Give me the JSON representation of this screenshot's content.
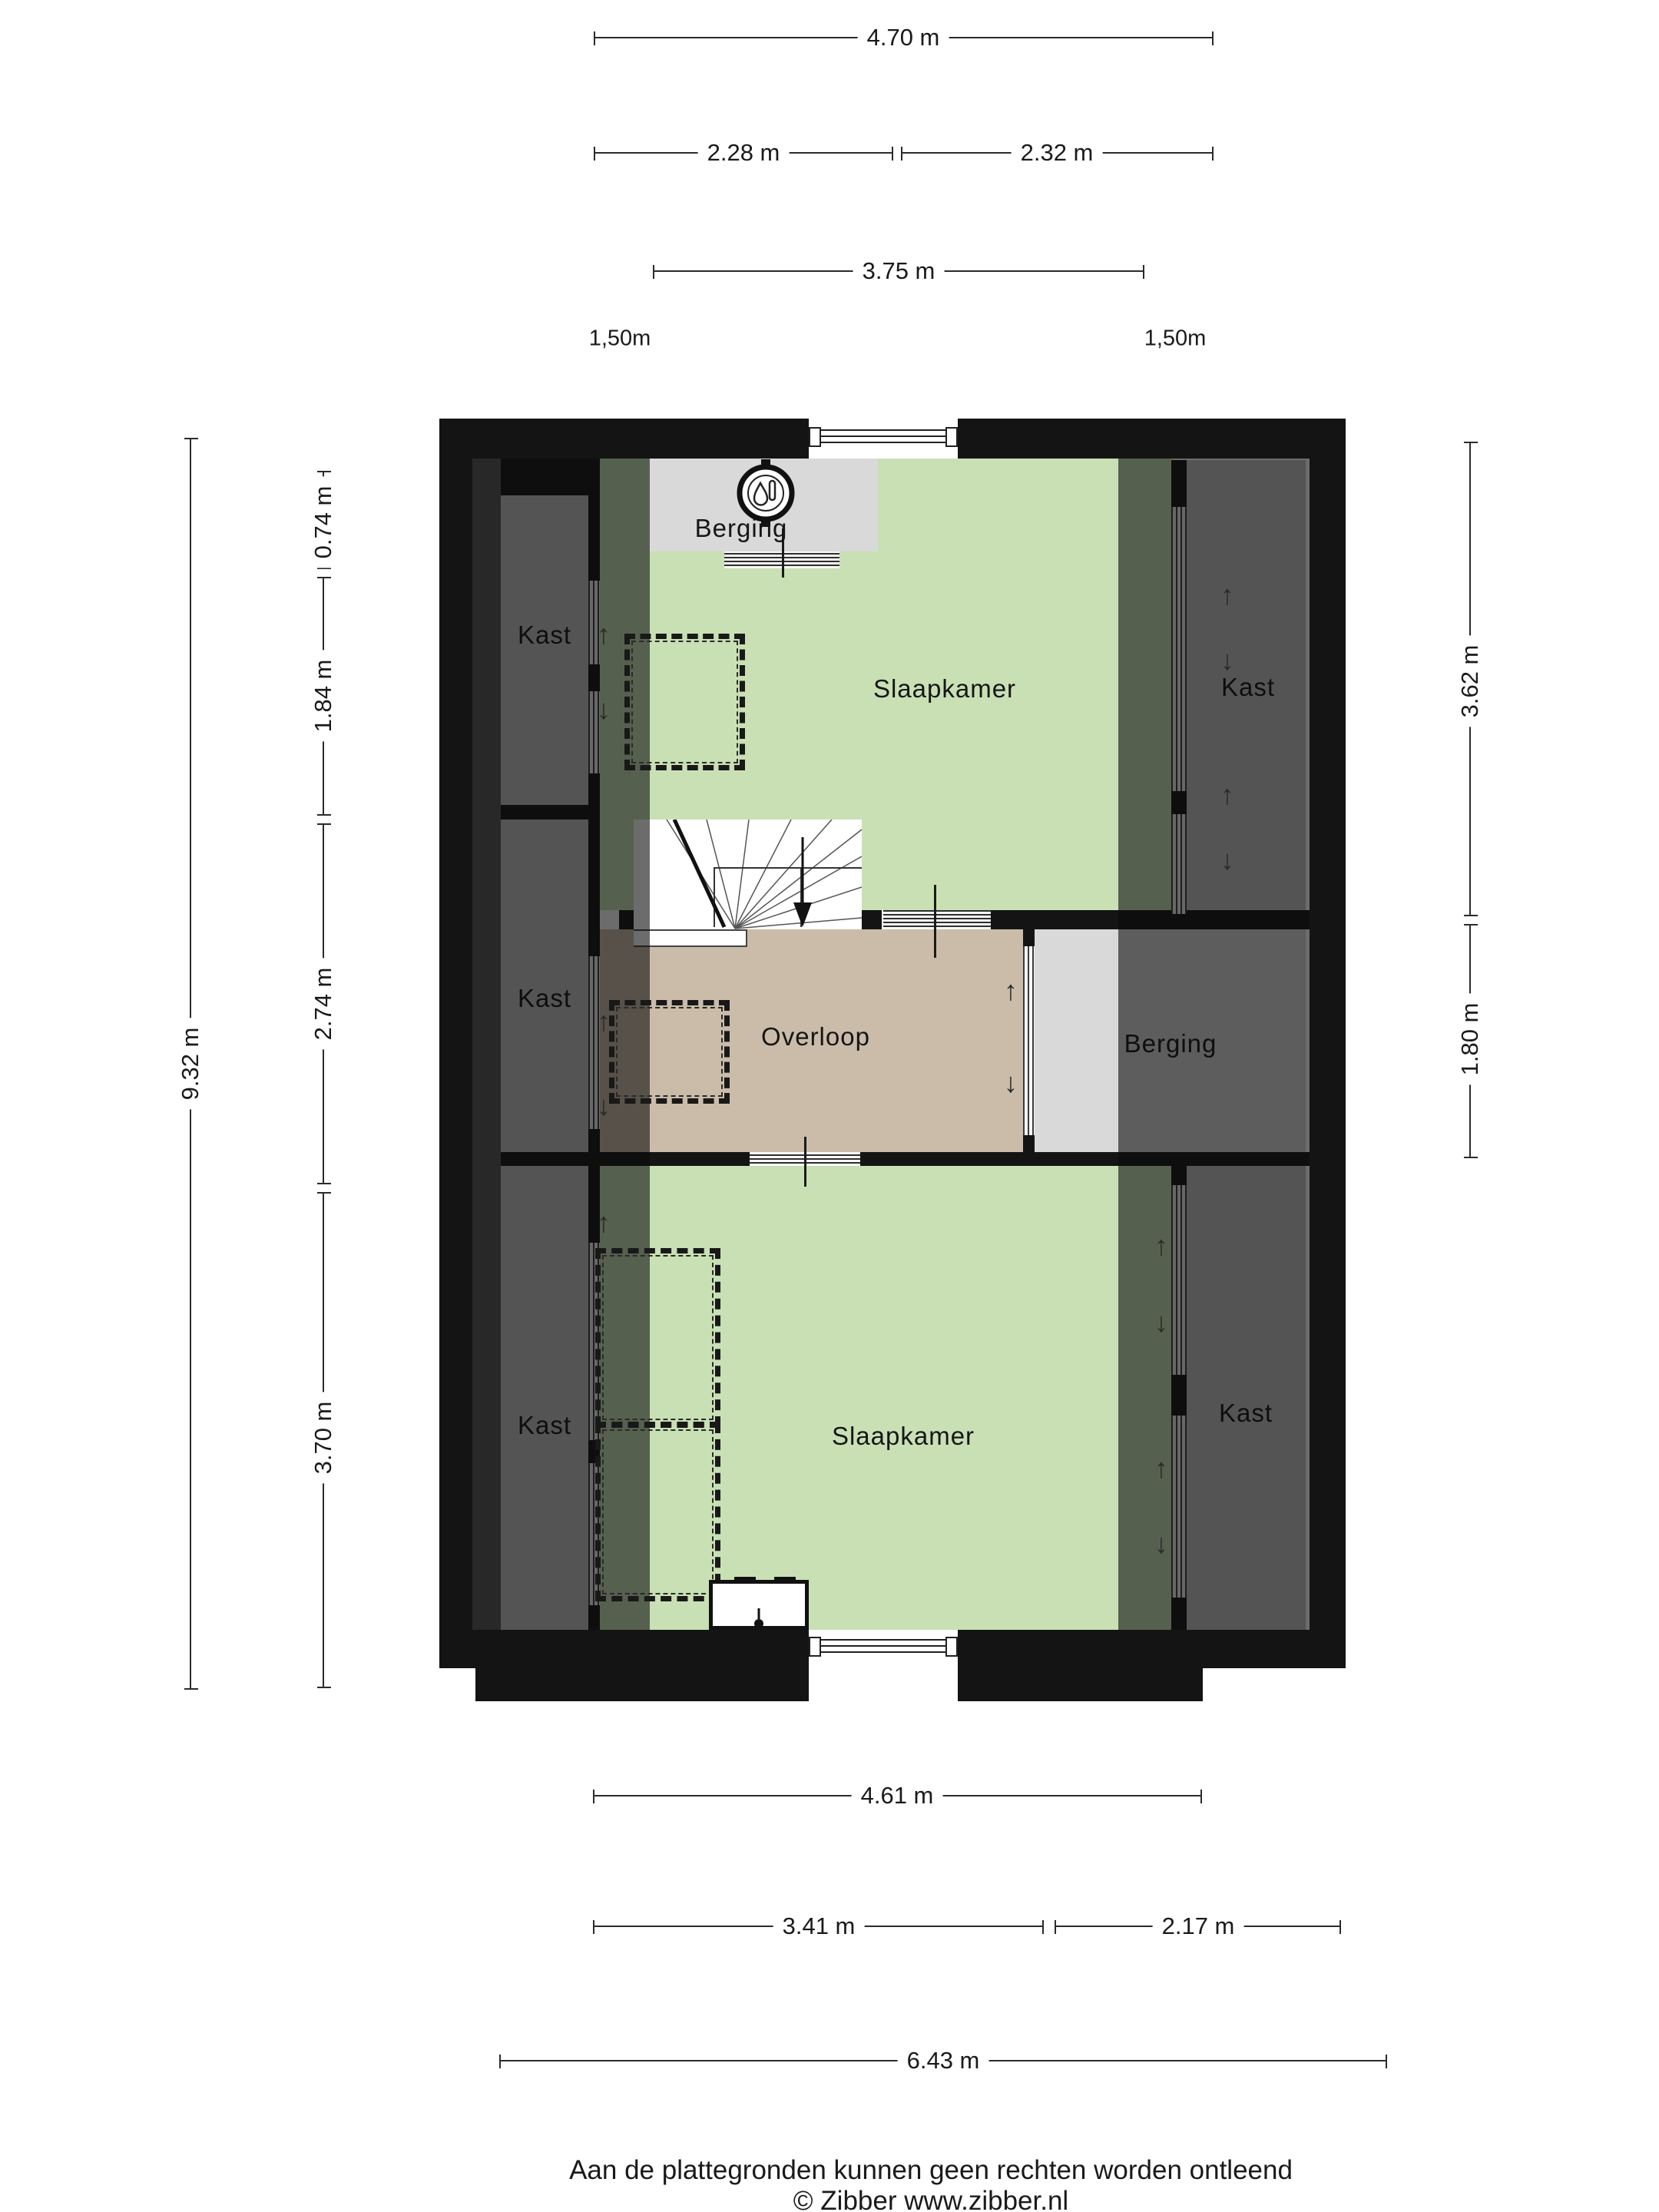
{
  "title": "Floor plan (verdieping)",
  "icons": {
    "arrow_up": "↑",
    "arrow_down": "↓",
    "boiler": "boiler-icon",
    "mv_unit": "mechanical-ventilation-icon"
  },
  "rooms": {
    "berging_top": "Berging",
    "slaapkamer_top": "Slaapkamer",
    "kast_top_left": "Kast",
    "kast_top_right": "Kast",
    "kast_middle_left": "Kast",
    "overloop": "Overloop",
    "berging_right": "Berging",
    "kast_bottom_left": "Kast",
    "slaapkamer_bottom": "Slaapkamer",
    "kast_bottom_right": "Kast"
  },
  "dimensions": {
    "top": {
      "overall": "4.70 m",
      "left_part": "2.28 m",
      "right_part": "2.32 m",
      "inner": "3.75 m",
      "height_line_left": "1,50m",
      "height_line_right": "1,50m"
    },
    "left": {
      "overall": "9.32 m",
      "segments": [
        "0.74 m",
        "1.84 m",
        "2.74 m",
        "3.70 m"
      ]
    },
    "right": {
      "segments": [
        "3.62 m",
        "1.80 m"
      ]
    },
    "bottom": {
      "room_width": "4.61 m",
      "left_part": "3.41 m",
      "right_part": "2.17 m",
      "overall": "6.43 m"
    }
  },
  "footer": {
    "disclaimer": "Aan de plattegronden kunnen geen rechten worden ontleend",
    "credit": "© Zibber www.zibber.nl"
  }
}
